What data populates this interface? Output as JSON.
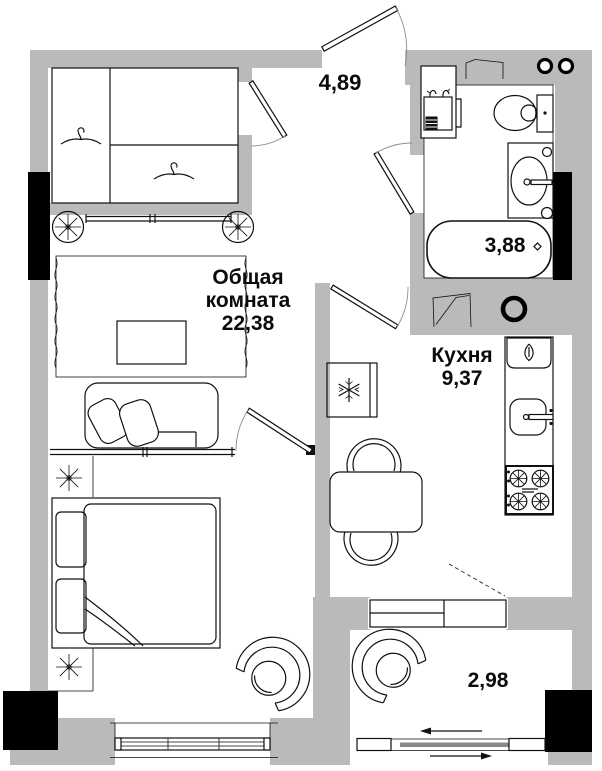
{
  "colors": {
    "wall": "#bababa",
    "column": "#000000",
    "line": "#111111",
    "background": "#ffffff",
    "glass": "#8a8a8a"
  },
  "rooms": {
    "living": {
      "name_line1": "Общая",
      "name_line2": "комната",
      "area": "22,38"
    },
    "kitchen": {
      "name": "Кухня",
      "area": "9,37"
    },
    "hallway": {
      "area": "4,89"
    },
    "bathroom": {
      "area": "3,88"
    },
    "balcony": {
      "area": "2,98"
    }
  },
  "icons": {
    "wardrobe": "clothes-hanger-icon",
    "wardrobe_rollers": "roller-wheel-icon",
    "plants": "plant-icon",
    "sofa": "sofa-icon",
    "coffee_table": "coffee-table-icon",
    "rug": "rug-icon",
    "bed": "double-bed-icon",
    "armchairs": "armchair-icon",
    "fridge": "snowflake-icon",
    "dining_set": "table-and-chairs-icon",
    "kitchen_sink": "sink-icon",
    "stove": "gas-stove-icon",
    "washing_machine": "washing-machine-icon",
    "toilet": "toilet-icon",
    "bathroom_sink": "washbasin-icon",
    "bathtub": "bathtub-icon",
    "vent_shaft": "ventilation-icon",
    "risers": "pipe-riser-icon",
    "windows": "window-icon",
    "balcony_slider": "sliding-window-icon",
    "doors": "door-swing-icon"
  }
}
